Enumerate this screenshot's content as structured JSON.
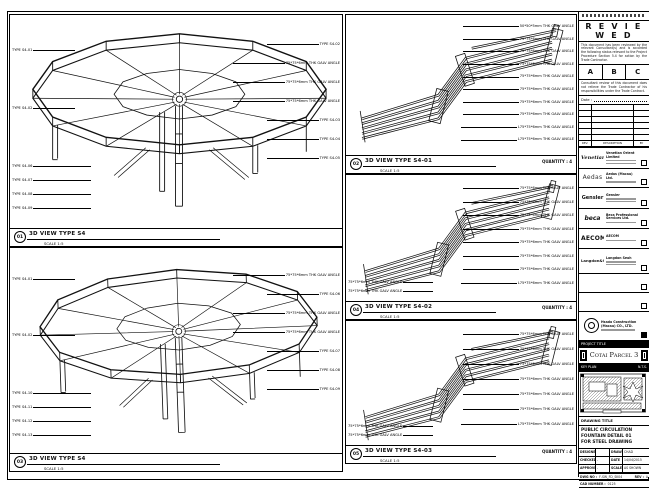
{
  "stamp": {
    "title": "R E V I E W E D",
    "body": "This document has been reviewed by the relevant Consultant(s) and is accorded the following status relevant to the Project Procedure Section 5.4 for action by the Trade Contractor.",
    "grades": [
      "A",
      "B",
      "C"
    ],
    "note": "Consultant review of this document does not relieve the Trade Contractor of his responsibilities under the Trade Contract.",
    "date_label": "Date :"
  },
  "revision_table": {
    "footer": [
      "REV.",
      "DESCRIPTION",
      "BY"
    ]
  },
  "companies": [
    {
      "logo": "Venetian",
      "name": "Venetian Orient Limited"
    },
    {
      "logo": "Aedas",
      "name": "Aedas (Macau) Ltd."
    },
    {
      "logo": "Gensler",
      "name": "Gensler"
    },
    {
      "logo": "beca",
      "name": "Beca Professional Services Ltd."
    },
    {
      "logo": "AECOM",
      "name": "AECOM"
    },
    {
      "logo": "Langdon&Seah",
      "name": "Langdon Seah"
    }
  ],
  "contractor": {
    "name": "Hsada Construction",
    "name2": "(Macau) CO., LTD."
  },
  "project": {
    "strip_label": "PROJECT TITLE",
    "name": "Cotai Parcel 3"
  },
  "key_plan": {
    "label": "KEY PLAN",
    "scale": "N.T.S."
  },
  "title_block": {
    "strip_label": "DRAWING TITLE",
    "lines": [
      "PUBLIC CIRCULATION",
      "FOUNTAIN DETAIL 01",
      "FOR STEEL DRAWING"
    ],
    "fields": {
      "designed_label": "DESIGNED",
      "designed": "",
      "drawn_label": "DRAWN",
      "drawn": "CHAD",
      "checked_label": "CHECKED",
      "checked": "-",
      "date_label": "DATE",
      "date": "14/04/2015",
      "approved_label": "APPROVED",
      "approved": "-",
      "scale_label": "SCALE",
      "scale": "AS SHOWN",
      "dwg_label": "DWG NO :",
      "dwg_no": "F-SW_FD_SK04",
      "rev_label": "REV :",
      "rev": "A",
      "cad_label": "CAD NUMBER :",
      "cad_no": "0125",
      "file_label": "CAD FILE NAME :",
      "file": "F-SW_FD_SK04.dwg",
      "ref_label": "REFERENCE :",
      "ref": ""
    }
  },
  "panels": {
    "tl": {
      "bubble": "01",
      "caption": "3D VIEW TYPE S4",
      "scale": "SCALE 1:5",
      "left_labels": [
        "TYPE S4-01",
        "TYPE S4-02"
      ],
      "bottom_labels": [
        "TYPE S4-06",
        "TYPE S4-07",
        "TYPE S4-08",
        "TYPE S4-09"
      ],
      "right_labels": [
        "TYPE S4-02",
        "75*75*6mm THK GALV ANGLE",
        "75*75*6mm THK GALV ANGLE",
        "75*75*6mm THK GALV ANGLE",
        "TYPE S4-03",
        "TYPE S4-04",
        "TYPE S4-05"
      ]
    },
    "bl": {
      "bubble": "03",
      "caption": "3D VIEW TYPE S4",
      "scale": "SCALE 1:5",
      "left_labels": [
        "TYPE S4-01",
        "TYPE S4-02"
      ],
      "bottom_labels": [
        "TYPE S4-10",
        "TYPE S4-11",
        "TYPE S4-12",
        "TYPE S4-13"
      ],
      "right_labels": [
        "75*75*6mm THK GALV ANGLE",
        "TYPE S4-06",
        "75*75*6mm THK GALV ANGLE",
        "75*75*6mm THK GALV ANGLE",
        "TYPE S4-07",
        "TYPE S4-08",
        "TYPE S4-09"
      ]
    },
    "m1": {
      "bubble": "02",
      "caption": "3D VIEW TYPE S4-01",
      "scale": "SCALE 1:5",
      "quantity": "QUANTITY : 4",
      "right_labels": [
        "50*50*5mm THK GALV ANGLE",
        "75*75*6mm THK GALV ANGLE",
        "75*75*6mm THK GALV ANGLE",
        "75*75*6mm THK GALV ANGLE",
        "75*75*6mm THK GALV ANGLE",
        "75*75*6mm THK GALV ANGLE",
        "75*75*6mm THK GALV ANGLE",
        "75*75*6mm THK GALV ANGLE",
        "L75*75*6mm THK GALV ANGLE",
        "L75*75*6mm THK GALV ANGLE"
      ]
    },
    "m2": {
      "bubble": "04",
      "caption": "3D VIEW TYPE S4-02",
      "scale": "SCALE 1:5",
      "quantity": "QUANTITY : 4",
      "left_labels": [
        "75*75*6mm THK GALV ANGLE",
        "75*75*6mm THK GALV ANGLE"
      ],
      "right_labels": [
        "75*75*6mm THK GALV ANGLE",
        "75*75*6mm THK GALV ANGLE",
        "75*75*6mm THK GALV ANGLE",
        "75*75*6mm THK GALV ANGLE",
        "75*75*6mm THK GALV ANGLE",
        "75*75*6mm THK GALV ANGLE",
        "75*75*6mm THK GALV ANGLE",
        "L75*75*6mm THK GALV ANGLE"
      ]
    },
    "m3": {
      "bubble": "05",
      "caption": "3D VIEW TYPE S4-03",
      "scale": "SCALE 1:5",
      "quantity": "QUANTITY : 4",
      "left_labels": [
        "75*75*6mm THK GALV ANGLE",
        "75*75*6mm THK GALV ANGLE"
      ],
      "right_labels": [
        "75*75*6mm THK GALV ANGLE",
        "75*75*6mm THK GALV ANGLE",
        "75*75*6mm THK GALV ANGLE",
        "75*75*6mm THK GALV ANGLE",
        "75*75*6mm THK GALV ANGLE",
        "75*75*6mm THK GALV ANGLE",
        "L75*75*6mm THK GALV ANGLE"
      ]
    }
  }
}
